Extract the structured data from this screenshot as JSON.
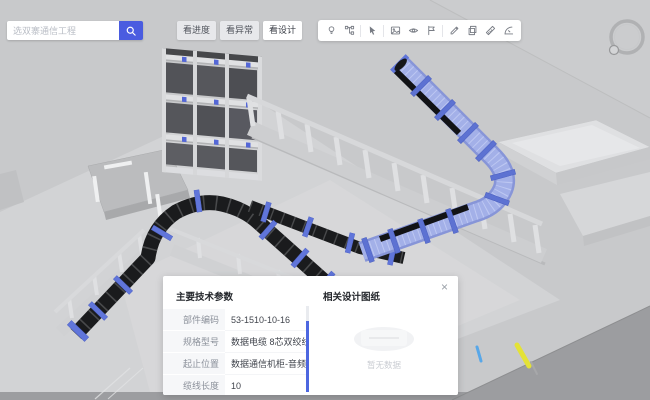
{
  "search": {
    "placeholder": "选双寨通信工程"
  },
  "view_modes": [
    {
      "label": "看进度",
      "active": false
    },
    {
      "label": "看异常",
      "active": false
    },
    {
      "label": "看设计",
      "active": true
    }
  ],
  "toolbar": {
    "icons": [
      "bulb",
      "model-tree",
      "select-cursor",
      "snapshot",
      "eye",
      "flag",
      "annotate",
      "copy",
      "measure",
      "angle"
    ]
  },
  "panel": {
    "close_label": "×",
    "params_title": "主要技术参数",
    "rows": [
      {
        "label": "部件编码",
        "value": "53-1510-10-16"
      },
      {
        "label": "规格型号",
        "value": "数据电缆 8芯双绞线 非屏蔽 —"
      },
      {
        "label": "起止位置",
        "value": "数据通信机柜-音频与数据配—"
      },
      {
        "label": "缆线长度",
        "value": "10"
      }
    ],
    "drawings_title": "相关设计图纸",
    "empty_text": "暂无数据"
  },
  "colors": {
    "accent": "#4a5ce0",
    "selected_tray": "#9aa8e4",
    "cable_tray": "#1a1b1d",
    "viewport_bg": "#c8c9cb"
  }
}
